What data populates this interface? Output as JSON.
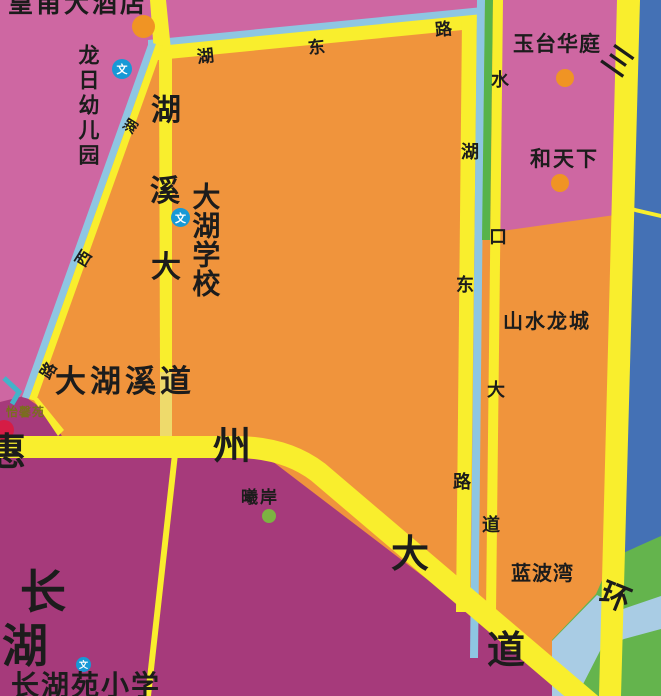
{
  "map_description": "city street map tile",
  "colors": {
    "area_pink": "#ce67a2",
    "area_orange": "#f0943c",
    "area_purple": "#a63a7b",
    "area_blue": "#4471b5",
    "area_green": "#64b44d",
    "area_lightblue_band": "#a9cce4",
    "road_yellow": "#f9ee2d",
    "road_yellow_pale": "#eeda6b",
    "road_edge_blue": "#8ec6e2",
    "road_edge_green": "#57b34a",
    "road_edge_teal": "#44b3c9",
    "poi_orange": "#f09424",
    "poi_green": "#7cb342",
    "poi_red": "#d61c45",
    "wen_icon_blue": "#1799d6",
    "label_text": "#1c1c1c",
    "label_olive": "#7a6e1e"
  },
  "places": {
    "hotel": "皇甫大酒店",
    "kindergarten": "龙日幼儿园",
    "school": "大湖学校",
    "yutai": "玉台华庭",
    "hetianxia": "和天下",
    "shanshuilongcheng": "山水龙城",
    "lanbowan": "蓝波湾",
    "xian": "曦岸",
    "yixinyuan": "怡馨苑",
    "changhu": [
      "长",
      "湖"
    ],
    "changhuyuan_school": "长湖苑小学"
  },
  "roads": {
    "hudonglu_top": [
      "湖",
      "东",
      "路"
    ],
    "huxilu": [
      "湖",
      "西",
      "路"
    ],
    "huxidadao_vertical": [
      "湖",
      "溪",
      "大"
    ],
    "dahuxidao": "大湖溪道",
    "shuikoudadao": [
      "水",
      "口",
      "大",
      "道"
    ],
    "hudonglu_vertical": [
      "湖",
      "东",
      "路"
    ],
    "huizhoudadao": [
      "惠",
      "州",
      "大",
      "道"
    ],
    "sanhuanlu": [
      "三",
      "环"
    ]
  },
  "icons": {
    "wen_label": "文"
  }
}
